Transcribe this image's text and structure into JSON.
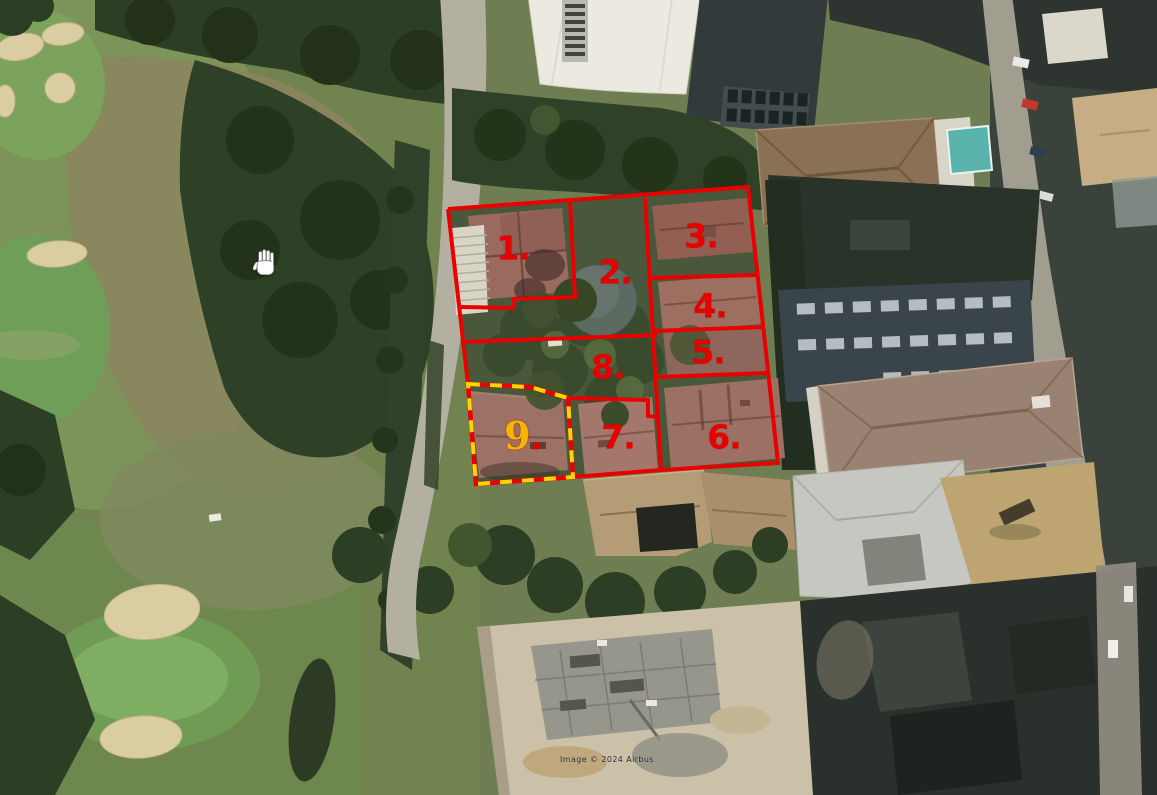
{
  "map": {
    "view_type": "satellite-aerial",
    "attribution": "Image © 2024 Airbus",
    "cursor": "open-hand",
    "overlay": {
      "outline_color": "#e90000",
      "highlight_dash_color": "#ffd400",
      "parcel_labels": [
        {
          "text": "1.",
          "color": "#e60000"
        },
        {
          "text": "2.",
          "color": "#e60000"
        },
        {
          "text": "3.",
          "color": "#e60000"
        },
        {
          "text": "4.",
          "color": "#e60000"
        },
        {
          "text": "5.",
          "color": "#e60000"
        },
        {
          "text": "6.",
          "color": "#e60000"
        },
        {
          "text": "7.",
          "color": "#e60000"
        },
        {
          "text": "8.",
          "color": "#e60000"
        },
        {
          "digit": "9",
          "dot": ".",
          "digit_color": "#f2b600",
          "dot_color": "#e60000",
          "highlighted": true
        }
      ]
    },
    "scene_features": [
      "golf-course",
      "sand-bunkers",
      "tree-canopy",
      "access-road",
      "white-industrial-roof",
      "solar-panel-roof",
      "residential-block",
      "swimming-pool",
      "parking-structure",
      "construction-site"
    ]
  }
}
